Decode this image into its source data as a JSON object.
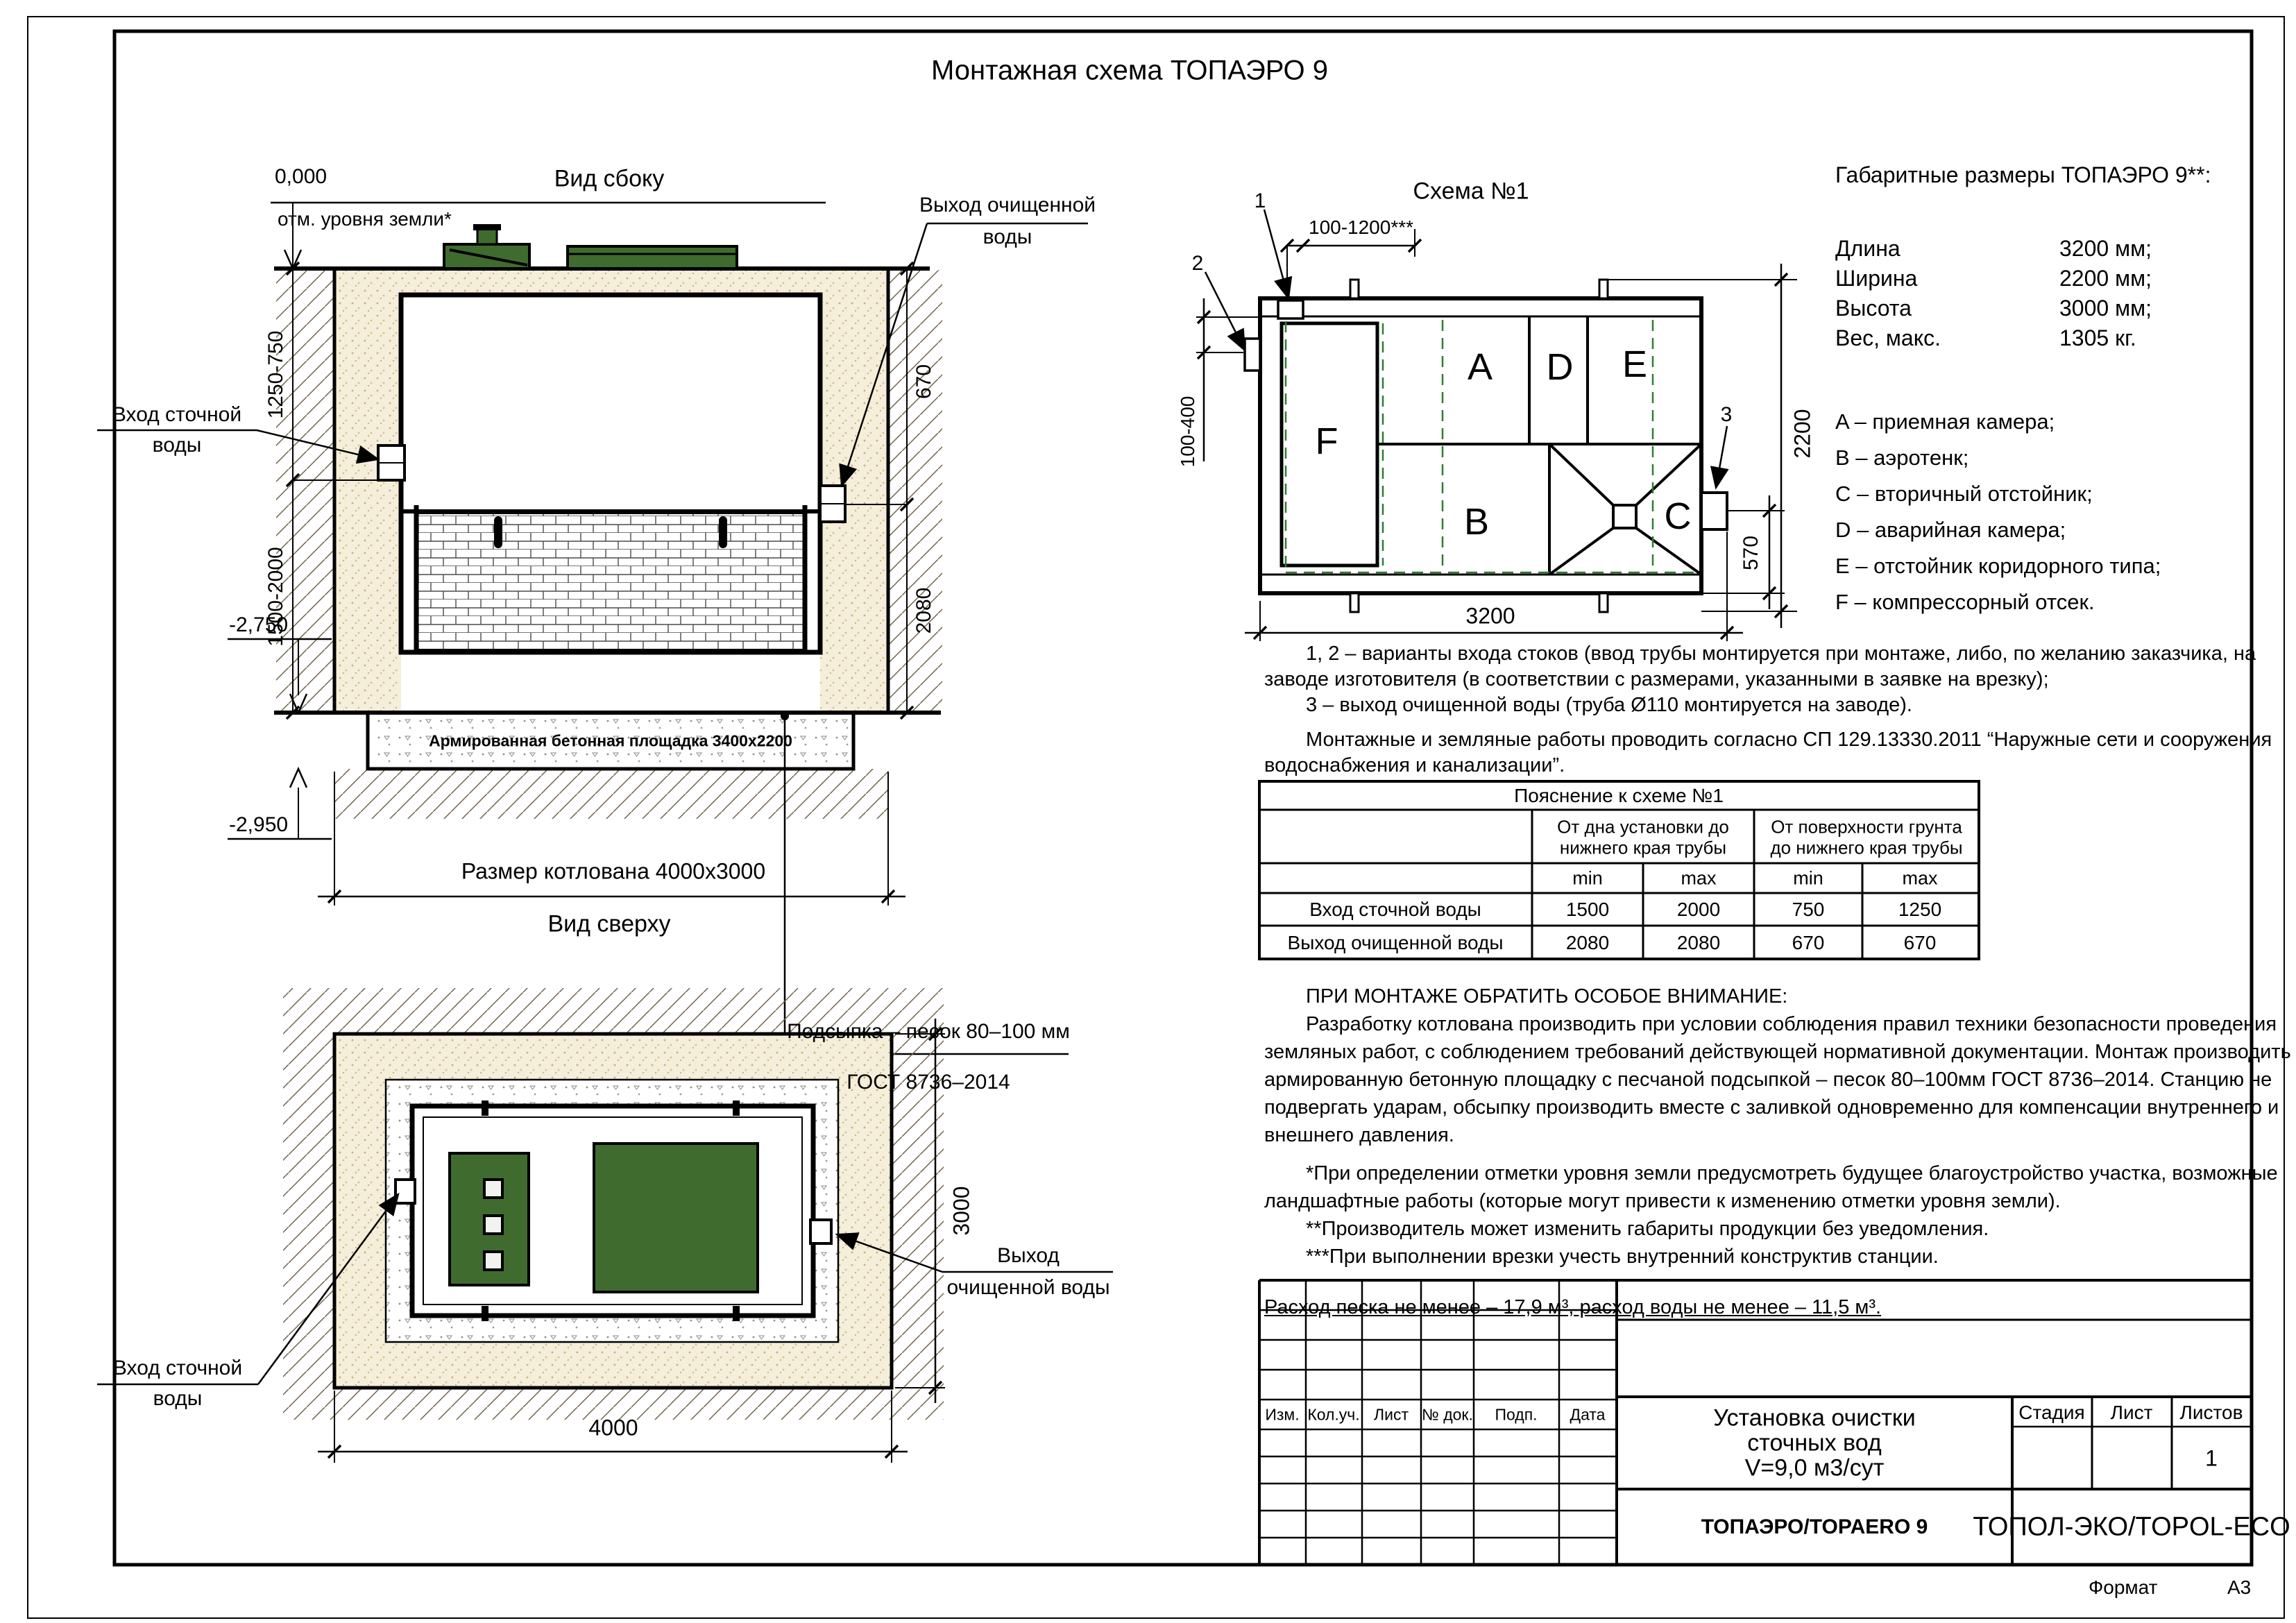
{
  "page": {
    "title": "Монтажная схема ТОПАЭРО 9",
    "format_label": "Формат",
    "format_value": "А3"
  },
  "side_view": {
    "view_title": "Вид сбоку",
    "zero_mark": "0,000",
    "ground_note": "отм. уровня земли*",
    "dim_left_upper": "1250-750",
    "dim_left_lower": "1500-2000",
    "elev_upper": "-2,750",
    "elev_lower": "-2,950",
    "inlet_label_1": "Вход сточной",
    "inlet_label_2": "воды",
    "outlet_label_1": "Выход очищенной",
    "outlet_label_2": "воды",
    "slab_label": "Армированная бетонная площадка 3400х2200",
    "pit_dim": "Размер котлована 4000х3000",
    "bedding_note_1": "Подсыпка – песок 80–100 мм",
    "bedding_note_2": "ГОСТ 8736–2014",
    "dim_right_upper": "670",
    "dim_right_lower": "2080"
  },
  "top_view": {
    "view_title": "Вид сверху",
    "inlet_label_1": "Вход сточной",
    "inlet_label_2": "воды",
    "outlet_label_1": "Выход",
    "outlet_label_2": "очищенной воды",
    "dim_width": "4000",
    "dim_height": "3000"
  },
  "schema": {
    "title": "Схема №1",
    "dim_top": "100-1200***",
    "dim_left": "100-400",
    "dim_right": "2200",
    "dim_outlet": "570",
    "dim_bottom": "3200",
    "marker_1": "1",
    "marker_2": "2",
    "marker_3": "3",
    "chamber_a": "A",
    "chamber_b": "B",
    "chamber_c": "C",
    "chamber_d": "D",
    "chamber_e": "E",
    "chamber_f": "F"
  },
  "specs": {
    "heading": "Габаритные размеры ТОПАЭРО 9**:",
    "rows": [
      {
        "label": "Длина",
        "value": "3200 мм;"
      },
      {
        "label": "Ширина",
        "value": "2200 мм;"
      },
      {
        "label": "Высота",
        "value": "3000 мм;"
      },
      {
        "label": "Вес, макс.",
        "value": "1305 кг."
      }
    ],
    "legend": [
      "A – приемная камера;",
      "B – аэротенк;",
      "C – вторичный отстойник;",
      "D – аварийная камера;",
      "E – отстойник коридорного типа;",
      "F – компрессорный отсек."
    ]
  },
  "notes": {
    "io": [
      "1, 2 – варианты входа  стоков (ввод трубы монтируется при монтаже, либо, по желанию заказчика, на",
      "заводе изготовителя (в соответствии с размерами, указанными в заявке на врезку);",
      "3 – выход очищенной воды (труба Ø110 монтируется на заводе)."
    ],
    "sp": [
      "Монтажные и земляные работы проводить согласно СП 129.13330.2011 “Наружные сети и сооружения",
      "водоснабжения и канализации”."
    ]
  },
  "table": {
    "title": "Пояснение к схеме №1",
    "group1_line1": "От дна установки до",
    "group1_line2": "нижнего края трубы",
    "group2_line1": "От поверхности грунта",
    "group2_line2": "до нижнего края трубы",
    "min": "min",
    "max": "max",
    "rows": [
      {
        "label": "Вход сточной воды",
        "v1": "1500",
        "v2": "2000",
        "v3": "750",
        "v4": "1250"
      },
      {
        "label": "Выход очищенной воды",
        "v1": "2080",
        "v2": "2080",
        "v3": "670",
        "v4": "670"
      }
    ]
  },
  "attention": {
    "heading": "ПРИ МОНТАЖЕ ОБРАТИТЬ ОСОБОЕ ВНИМАНИЕ:",
    "lines": [
      "Разработку котлована производить при условии соблюдения правил техники безопасности проведения",
      "земляных работ, с соблюдением требований действующей нормативной документации.  Монтаж производить на",
      "армированную бетонную площадку с песчаной подсыпкой – песок 80–100мм ГОСТ 8736–2014. Станцию не",
      "подвергать ударам, обсыпку производить вместе с заливкой одновременно для компенсации внутреннего и",
      "внешнего давления."
    ],
    "footnotes": [
      "*При определении отметки уровня земли предусмотреть будущее благоустройство участка, возможные",
      "ландшафтные работы (которые могут привести к изменению отметки уровня земли).",
      "**Производитель может изменить габариты продукции без уведомления.",
      "***При выполнении врезки учесть внутренний конструктив станции."
    ],
    "consumption": "Расход песка не менее – 17,9 м³, расход воды не менее – 11,5 м³."
  },
  "title_block": {
    "cols": [
      "Изм.",
      "Кол.уч.",
      "Лист",
      "№ док.",
      "Подп.",
      "Дата"
    ],
    "doc_title_1": "Установка очистки",
    "doc_title_2": "сточных вод",
    "doc_title_3": "V=9,0 м3/сут",
    "stage_label": "Стадия",
    "sheet_label": "Лист",
    "sheets_label": "Листов",
    "sheets_value": "1",
    "model": "ТОПАЭРО/TOPAERO 9",
    "brand": "ТОПОЛ-ЭКО/TOPOL-ECO"
  }
}
